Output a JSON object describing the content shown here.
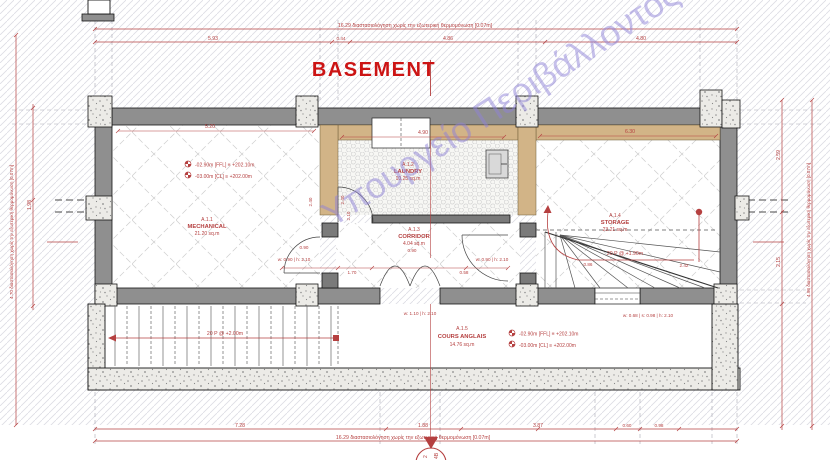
{
  "title": "BASEMENT",
  "watermark": "Υπουργείο Περιβάλλοντος",
  "colors": {
    "title": "#cc1414",
    "red": "#b54040",
    "watermark": "#8f82d8",
    "wall": "#8f8f8f",
    "insulation": "#d2b487"
  },
  "rooms": [
    {
      "id": "A.1.1",
      "name": "MECHANICAL",
      "area": "21.20 sq.m"
    },
    {
      "id": "A.1.2",
      "name": "LAUNDRY",
      "area": "10.25 sq.m"
    },
    {
      "id": "A.1.3",
      "name": "CORRIDOR",
      "area": "4.04 sq.m"
    },
    {
      "id": "A.1.4",
      "name": "STORAGE",
      "area": "23.21 sq.m"
    },
    {
      "id": "A.1.5",
      "name": "COURS ANGLAIS",
      "area": "14.76 sq.m"
    }
  ],
  "levels": {
    "ffl": "-02.90m [FFL] ≡ +202.10m",
    "cl": "-03.00m [CL] ≡ +202.00m"
  },
  "stairs": {
    "lower": "20 P @ +2.00m",
    "upper": "20 P @ +1.90m"
  },
  "doors": {
    "d090": "w: 0.90 | h: 2.10",
    "d110": "w: 1.10 | h: 2.10",
    "window": "w: 0.68 | s: 0.98 | h: 2.10"
  },
  "dims": {
    "top_note": "16.29 διαστασιολόγηση χωρίς την εξωτερική θερμομόνωση [0.07m]",
    "bottom_note": "16.29 διαστασιολόγηση χωρίς την εξωτερική θερμομόνωση [0.07m]",
    "left_note": "4.70 διαστασιολόγηση χωρίς την εξωτερική θερμομόνωση [0.07m]",
    "right_note": "4.98 διαστασιολόγηση χωρίς την εξωτερική θερμομόνωση [0.07m]",
    "top": [
      "5.93",
      "0.44",
      "4.86",
      "4.80"
    ],
    "bottom": [
      "7.28",
      "1.88",
      "3.87",
      "0.60",
      "0.98"
    ],
    "left": [
      "1.98"
    ],
    "right": [
      "2.59",
      "2.15"
    ],
    "room_width": [
      "5.20",
      "4.90",
      "6.30"
    ],
    "inner": {
      "a": "0.90",
      "b": "1.70",
      "c": "0.90",
      "d": "0.58",
      "e": "2.40",
      "f": "2.10",
      "g": "0.86",
      "h": "2.42"
    }
  },
  "section": {
    "a": "2",
    "b": "4B"
  }
}
